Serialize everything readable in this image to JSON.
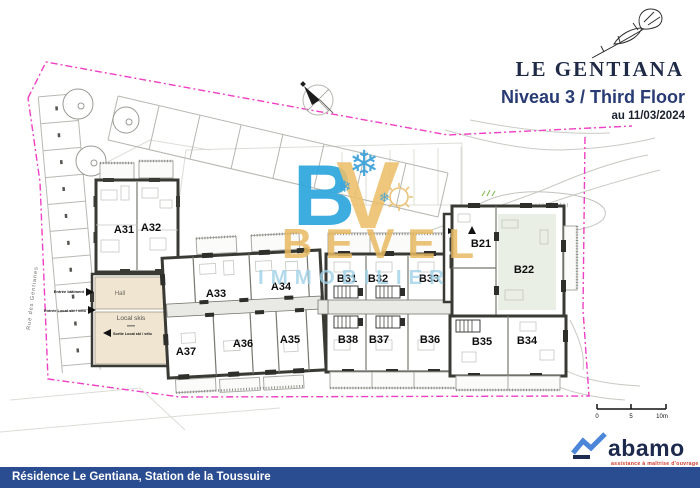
{
  "header": {
    "project": "LE GENTIANA",
    "floor_title": "Niveau 3 / Third Floor",
    "date_label": "au 11/03/2024"
  },
  "watermark": {
    "letter_b": "B",
    "letter_v": "V",
    "snowflake": "❄",
    "name": "BEVEL",
    "field": "IMMOBILIER"
  },
  "plan": {
    "street": "Rue des Gentianes",
    "rooms": {
      "hall": "Hall",
      "ski": "Local skis"
    },
    "notes": {
      "entry_building": "Entrée bâtiment",
      "entry_ski": "Entrée Local ski / vélo",
      "exit_ski": "Sortie Local ski / vélo"
    },
    "units": [
      "A31",
      "A32",
      "A33",
      "A34",
      "A36",
      "A35",
      "A37",
      "B31",
      "B32",
      "B33",
      "B38",
      "B37",
      "B36",
      "B35",
      "B34",
      "B21",
      "B22"
    ]
  },
  "scalebar": {
    "t0": "0",
    "t5": "5",
    "t10": "10m"
  },
  "brand": {
    "abamo": "abamo",
    "abamo_tagline": "assistance à maîtrise d'ouvrage"
  },
  "footer": {
    "address": "Résidence Le Gentiana, Station de la Toussuire"
  },
  "colors": {
    "boundary_pink": "#ef3fc4",
    "footer_blue": "#2a4c90",
    "title_navy": "#283b75",
    "watermark_blue": "#2da7dd",
    "watermark_gold": "#e8ba62",
    "room_beige": "#efe5d1",
    "room_green": "#e9efe5",
    "wall_dark": "#3a3a35",
    "abamo_navy": "#1d2a4d",
    "abamo_blue": "#4c86d9",
    "abamo_red": "#cf3a2a"
  }
}
